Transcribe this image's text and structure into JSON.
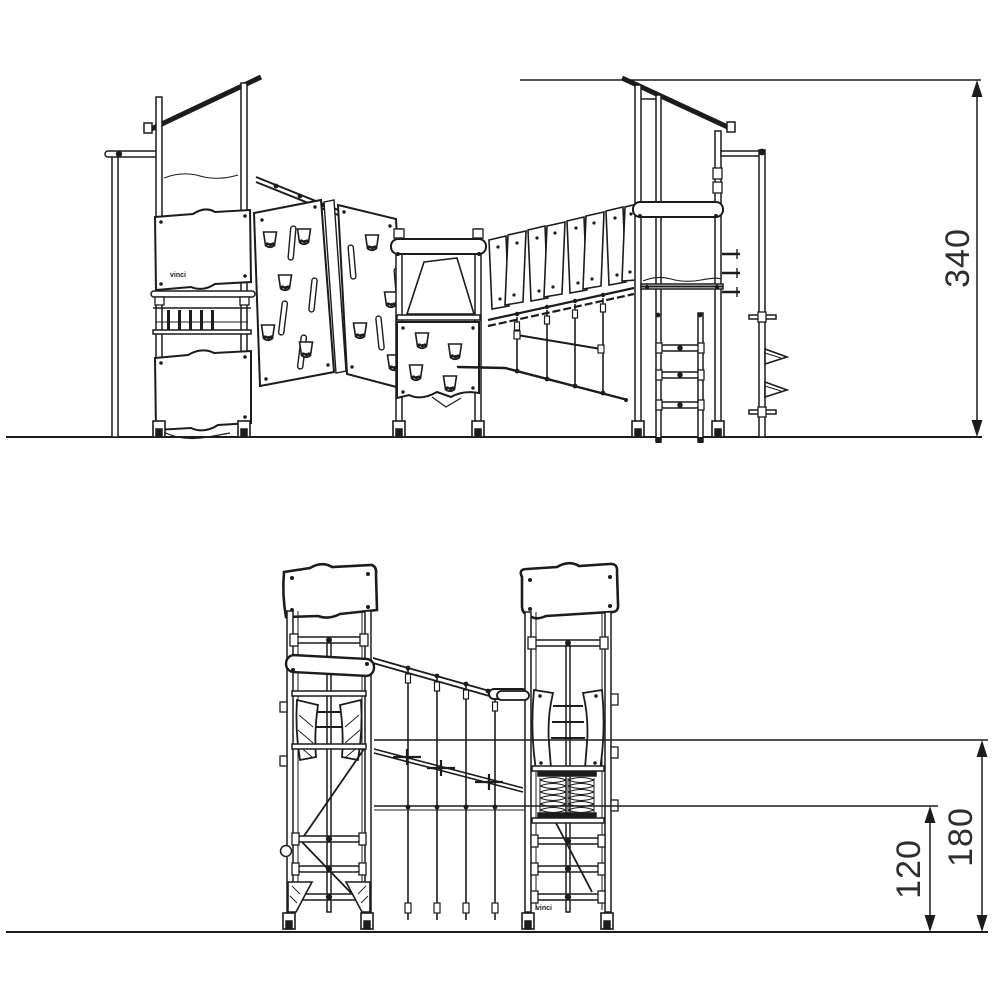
{
  "page": {
    "background": "#ffffff",
    "line_color": "#1c1c1c",
    "text_color": "#2e2e2e",
    "kind": "playground structure technical elevation drawing"
  },
  "drawing": {
    "views": {
      "side_elevation": {
        "name": "side elevation",
        "brand_mark": "vinci",
        "height_dimension": {
          "label": "340"
        }
      },
      "end_elevation": {
        "name": "end elevation",
        "brand_mark": "vinci",
        "upper_height_dimension": {
          "label": "180"
        },
        "lower_height_dimension": {
          "label": "120"
        }
      }
    }
  }
}
